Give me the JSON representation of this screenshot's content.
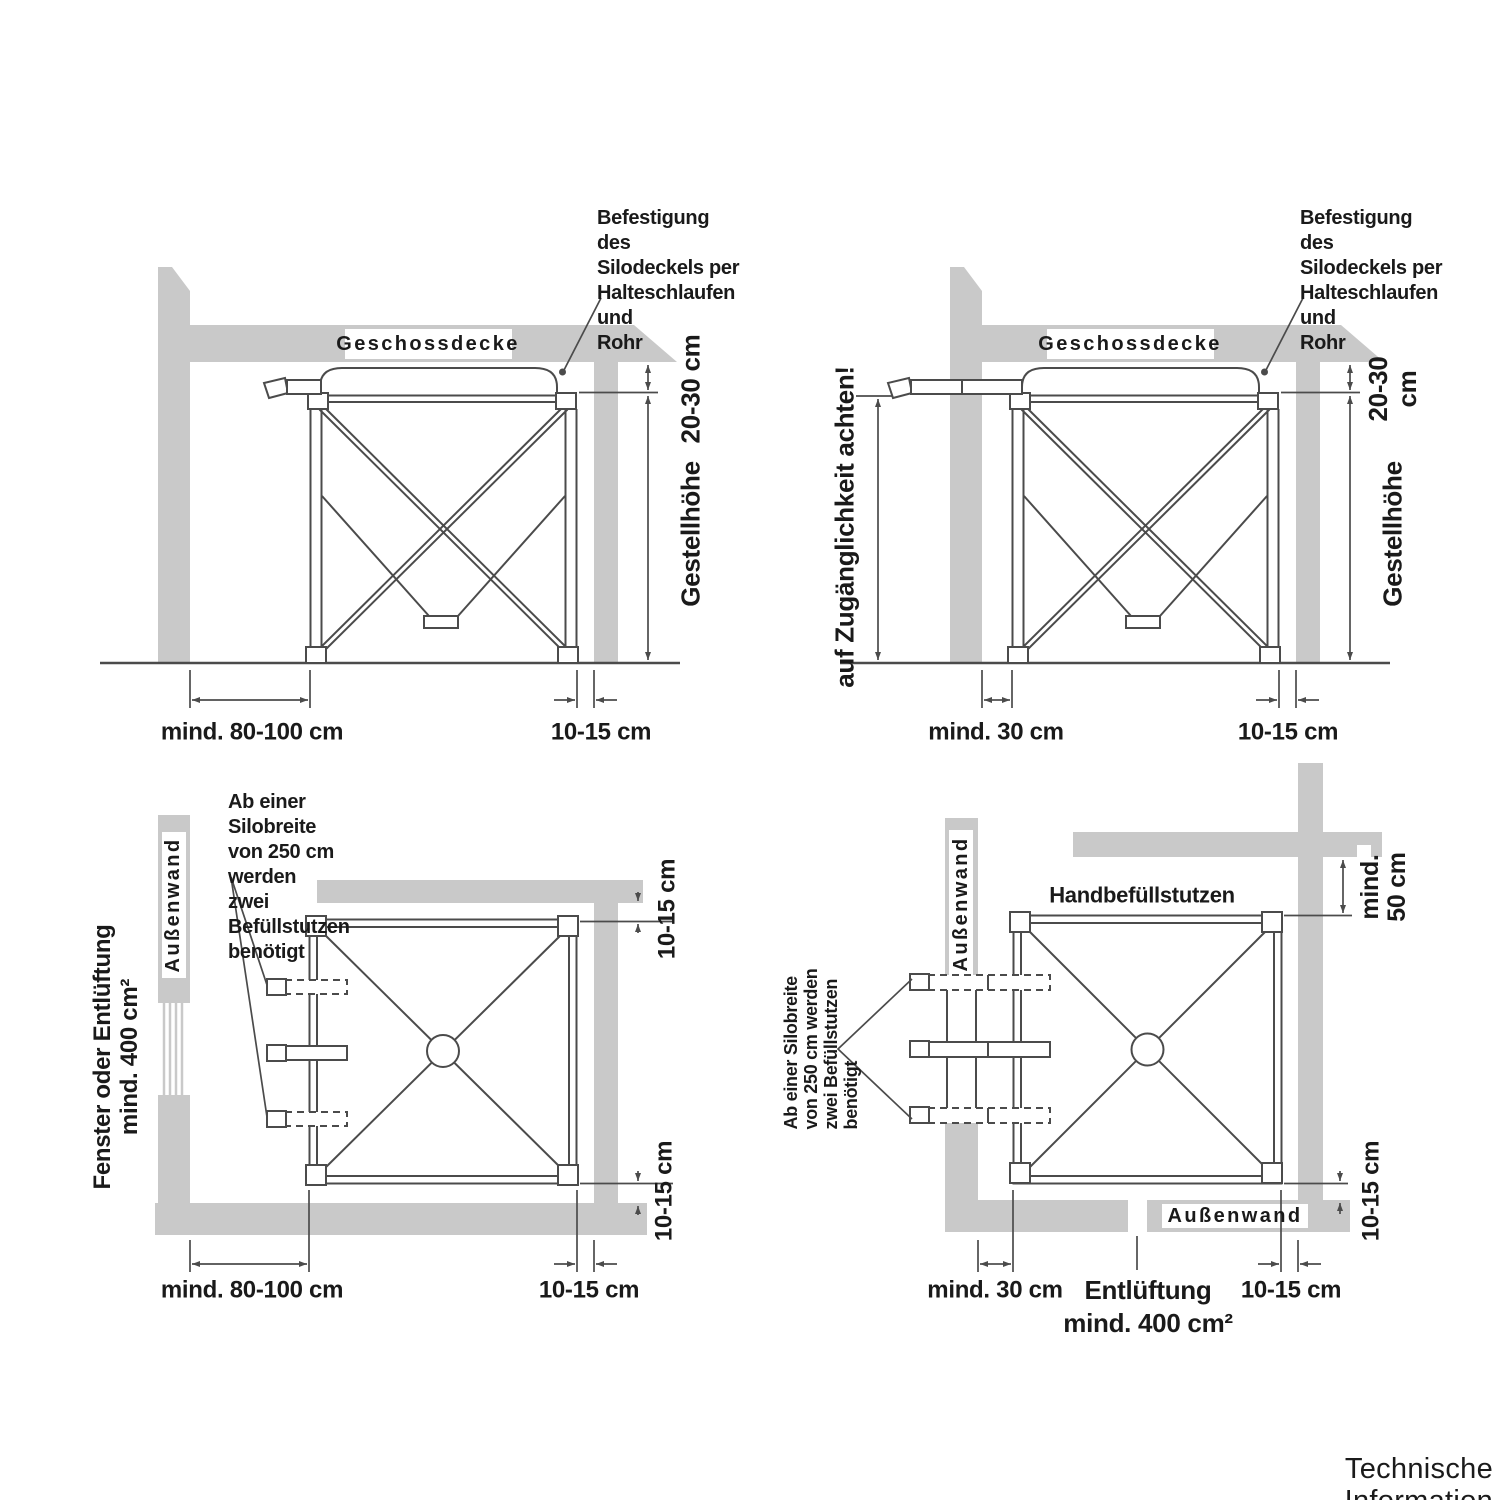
{
  "colors": {
    "wall": "#c9c9c9",
    "line": "#4b4b4b",
    "text": "#1a1a1a"
  },
  "footer": "Technische Information",
  "top_left": {
    "ceiling": "Geschossdecke",
    "note": "Befestigung des\nSilodeckels per\nHalteschlaufen und\nRohr",
    "dim_gap": "20-30 cm",
    "dim_height": "Gestellhöhe",
    "dim_wall": "mind. 80-100 cm",
    "dim_side": "10-15 cm"
  },
  "top_right": {
    "ceiling": "Geschossdecke",
    "note": "Befestigung des\nSilodeckels per\nHalteschlaufen und\nRohr",
    "access_note": "auf Zugänglichkeit achten!",
    "dim_gap": "20-30 cm",
    "dim_height": "Gestellhöhe",
    "dim_wall": "mind. 30 cm",
    "dim_side": "10-15 cm"
  },
  "bottom_left": {
    "note": "Ab einer Silobreite\nvon 250 cm werden\nzwei Befüllstutzen\nbenötigt",
    "window_label": "Fenster oder Entlüftung\nmind. 400 cm²",
    "wall_label": "Außenwand",
    "dim_top": "10-15 cm",
    "dim_bottom_v": "10-15 cm",
    "dim_wall": "mind. 80-100 cm",
    "dim_side": "10-15 cm"
  },
  "bottom_right": {
    "note": "Ab einer Silobreite\nvon 250 cm werden\nzwei Befüllstutzen\nbenötigt",
    "wall_label_left": "Außenwand",
    "wall_label_bottom": "Außenwand",
    "fill_label": "Handbefüllstutzen",
    "dim_top": "mind.\n50 cm",
    "dim_right_v": "10-15 cm",
    "dim_wall": "mind. 30 cm",
    "vent_label": "Entlüftung\nmind. 400 cm²",
    "dim_side": "10-15 cm"
  }
}
